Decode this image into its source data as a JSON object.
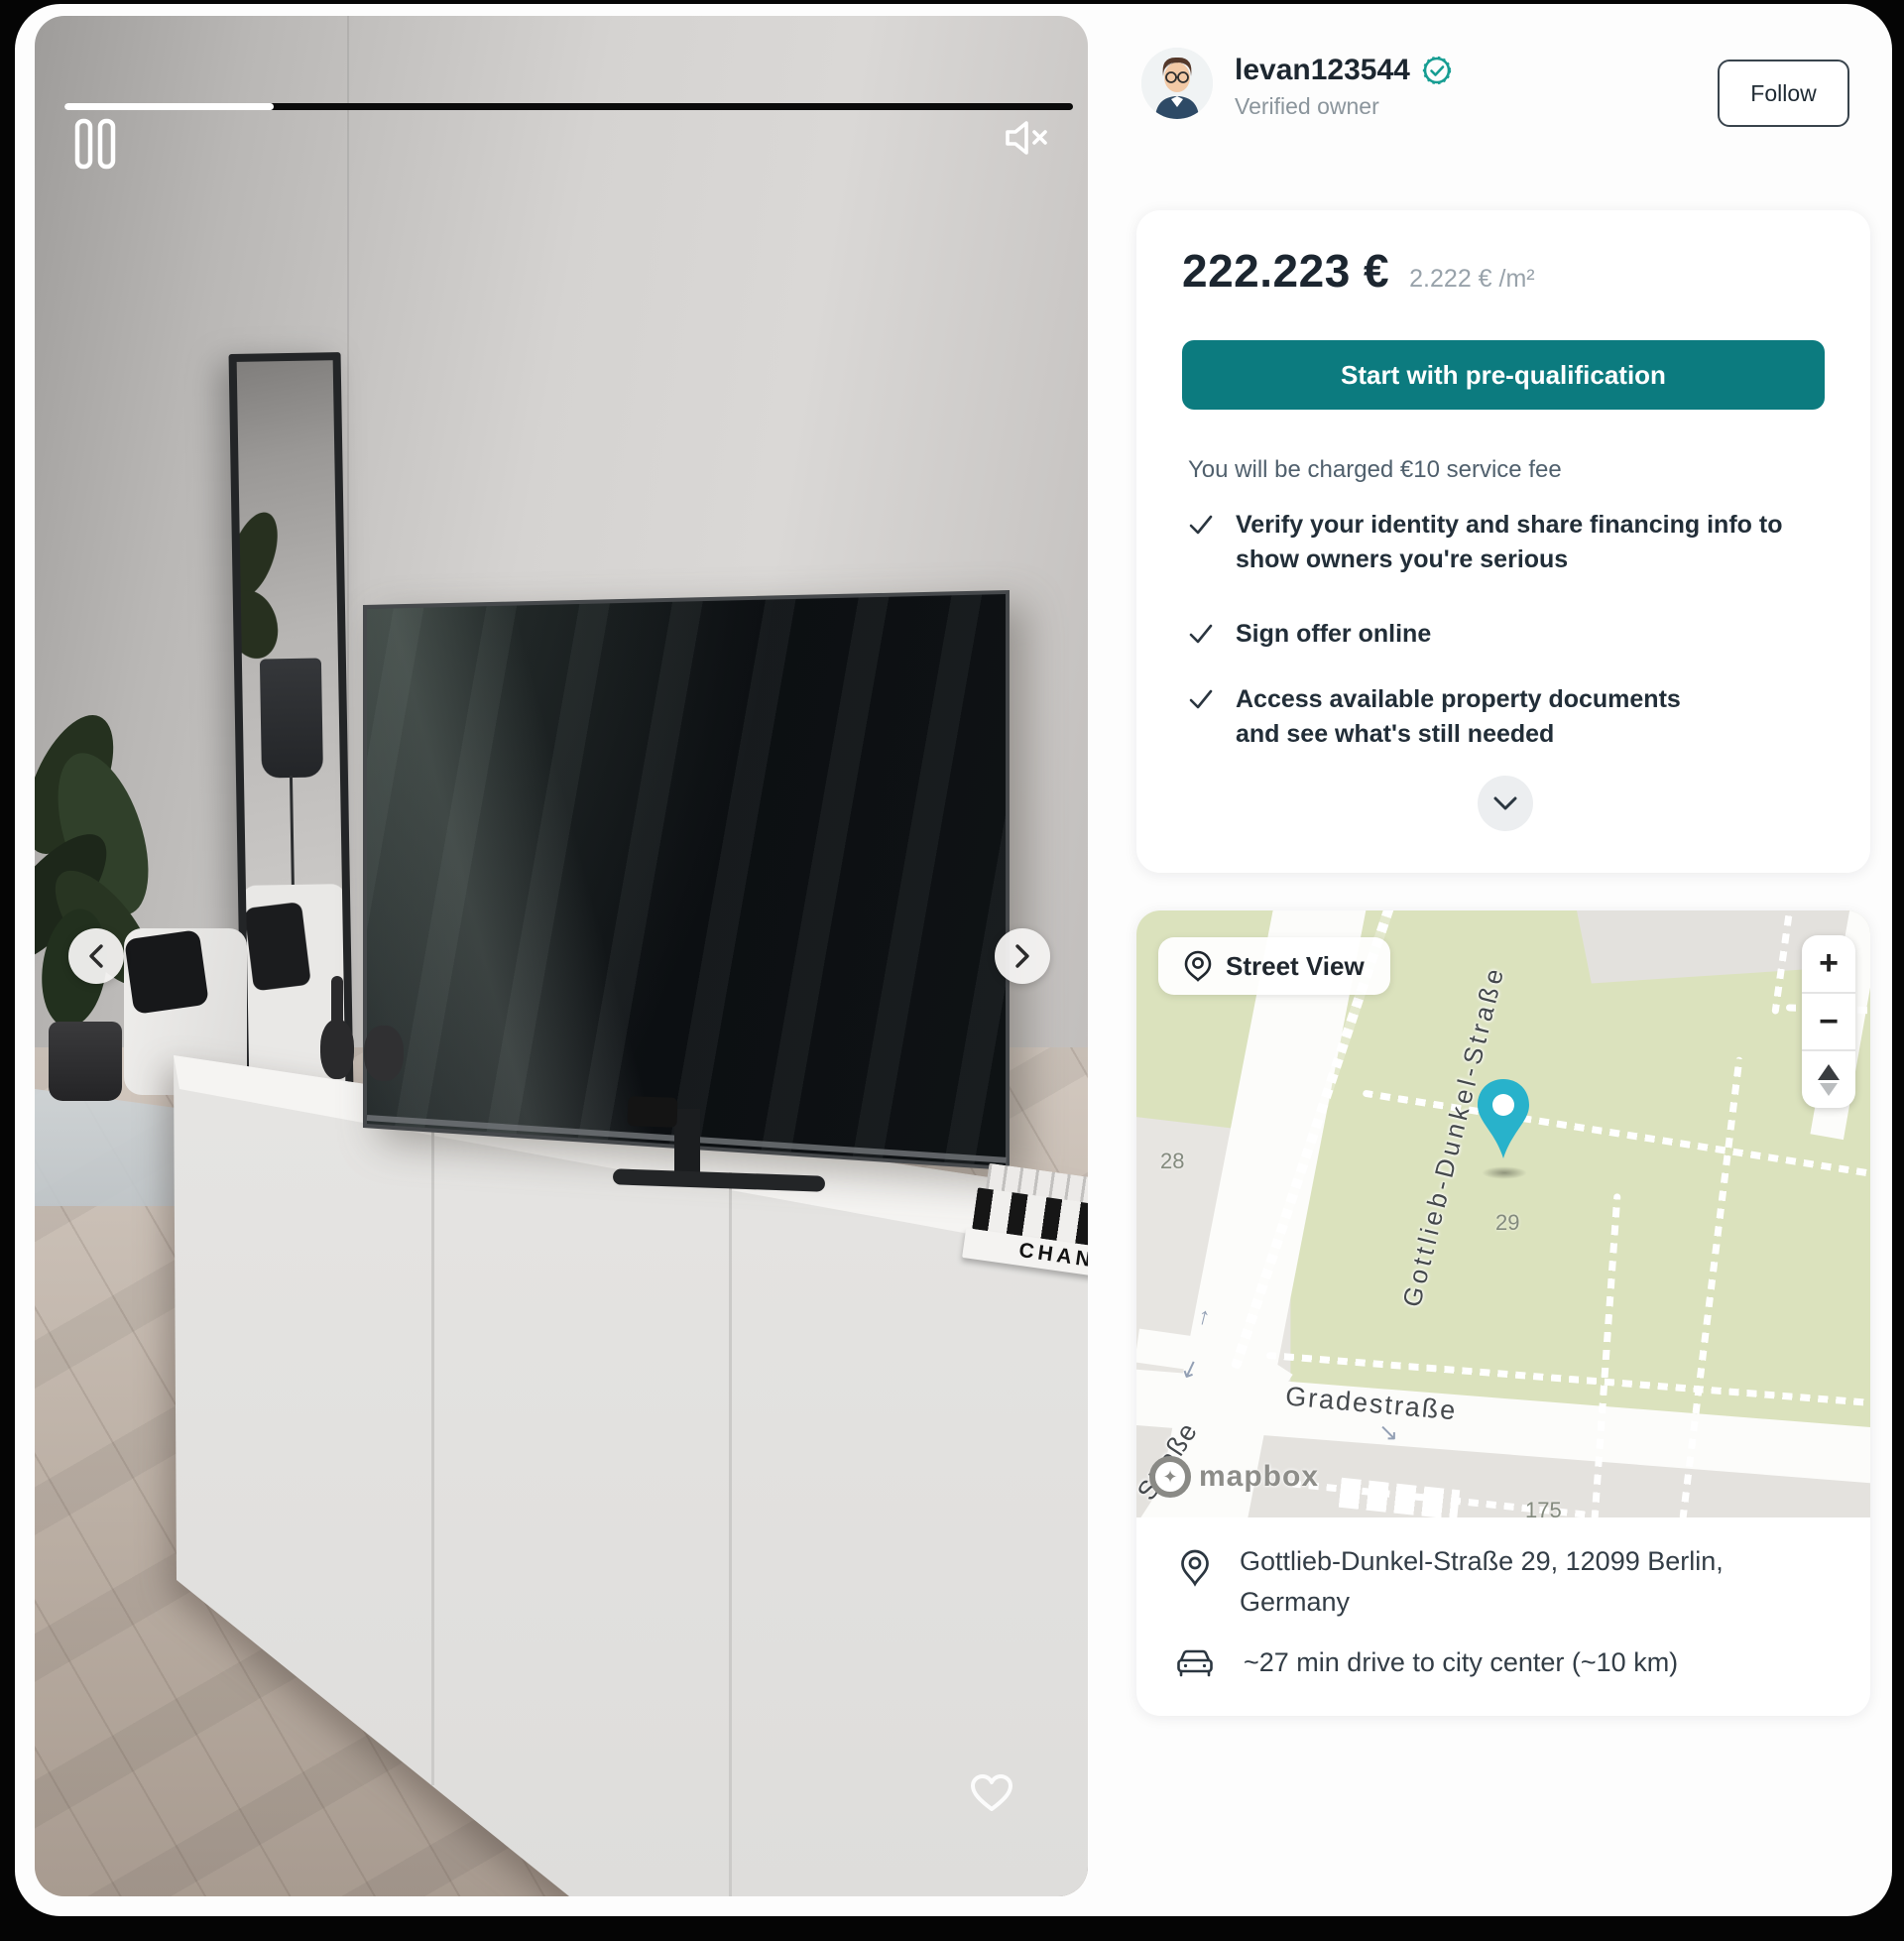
{
  "video": {
    "progress_percent": 20.7,
    "pause_icon": "pause-icon",
    "mute_icon": "muted-speaker-icon",
    "prev_label": "previous-photo",
    "next_label": "next-photo",
    "book_spine_text": "CHANEL"
  },
  "owner": {
    "username": "levan123544",
    "subtitle": "Verified owner",
    "follow_label": "Follow",
    "badge_color": "#169d92"
  },
  "pricing": {
    "price": "222.223 €",
    "unit_price": "2.222 € /m²",
    "cta_label": "Start with pre-qualification",
    "fee_note": "You will be charged €10 service fee",
    "benefits": [
      "Verify your identity and share financing info to show owners you're serious",
      "Sign offer online",
      "Access available property documents and see what's still needed"
    ],
    "accent_color": "#0c7b7f"
  },
  "map": {
    "street_view_label": "Street View",
    "street_label_main": "Gottlieb-Dunkel-Straße",
    "street_label_bottom": "Gradestraße",
    "street_label_corner": "Straße",
    "parcel_28": "28",
    "parcel_29": "29",
    "parcel_175": "175",
    "zoom_in": "+",
    "zoom_out": "−",
    "attribution": "mapbox",
    "pin_color": "#28b2cb",
    "land_color": "#dbe2bd"
  },
  "location": {
    "address": "Gottlieb-Dunkel-Straße 29, 12099 Berlin, Germany",
    "drive_note": "~27 min drive to city center (~10 km)"
  }
}
